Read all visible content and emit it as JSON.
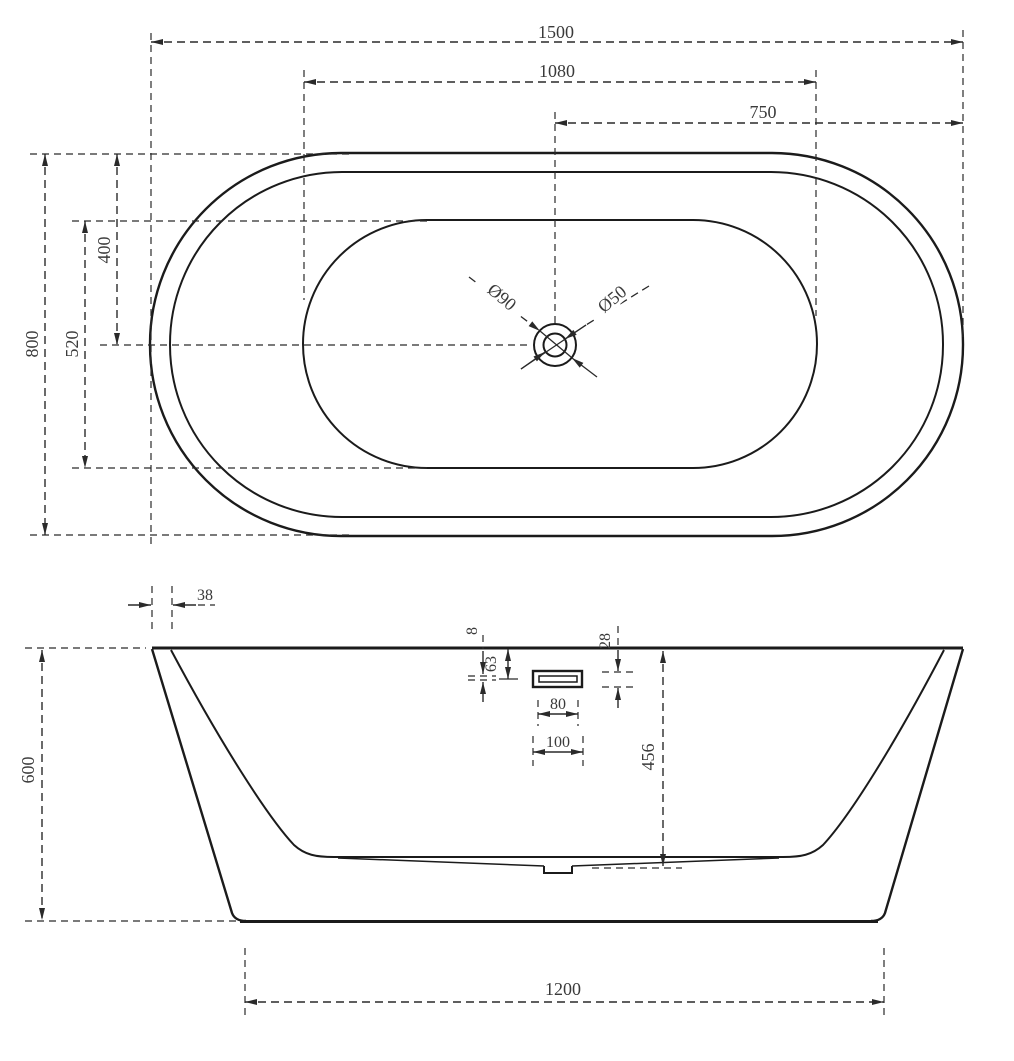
{
  "drawing": {
    "type": "bathtub technical dimension drawing",
    "background_color": "#ffffff",
    "line_color": "#1b1b1b",
    "text_color": "#3a3a3a"
  },
  "top_view": {
    "overall_length": "1500",
    "basin_length": "1080",
    "center_to_end": "750",
    "overall_width": "800",
    "basin_width": "520",
    "center_to_side": "400",
    "drain_outer_dia": "Ø90",
    "drain_inner_dia": "Ø50"
  },
  "front_view": {
    "rim_thickness": "38",
    "overflow_slot_height": "8",
    "overflow_top_offset": "63",
    "overflow_bezel_height": "28",
    "overflow_slot_width": "80",
    "overflow_bezel_width": "100",
    "inner_depth": "456",
    "overall_height": "600",
    "base_length": "1200"
  }
}
